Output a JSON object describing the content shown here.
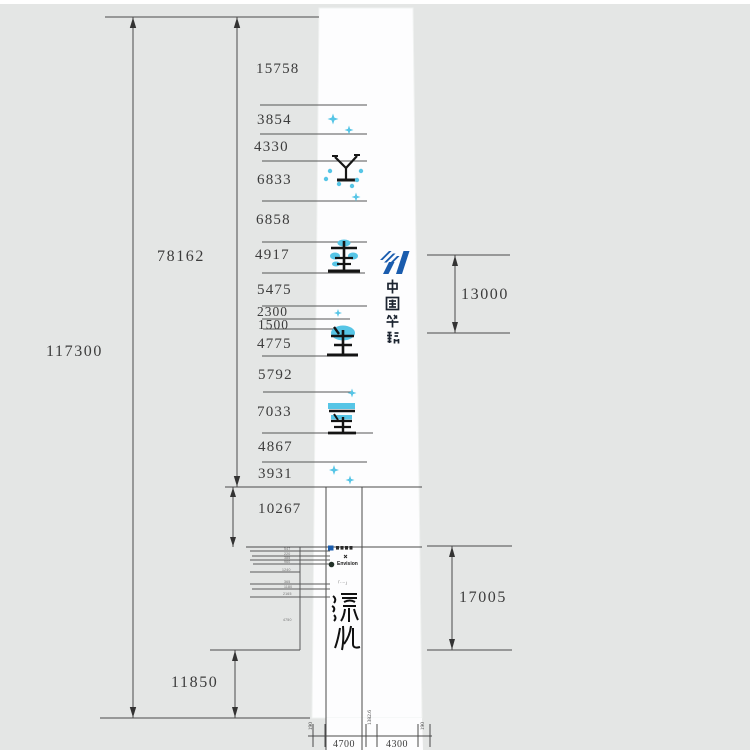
{
  "dimension_labels": {
    "total_height": "117300",
    "upper_section_height": "78162",
    "foundation_height": "11850",
    "logo_band_height": "13000",
    "artwork_band_height": "17005",
    "segments": [
      "15758",
      "3854",
      "4330",
      "6833",
      "6858",
      "4917",
      "5475",
      "2300",
      "1500",
      "4775",
      "5792",
      "7033",
      "4867",
      "3931",
      "10267"
    ],
    "base_widths": [
      "190",
      "4700",
      "1382.6",
      "4300",
      "190"
    ]
  },
  "branding": {
    "huaneng_wordmark": "中国华能",
    "partnership_mark": "×",
    "envision_label": "Envision"
  },
  "artwork": {
    "seal_script_characters": "演化",
    "plaque_caption": "「····」"
  },
  "detail_callout_labels": [
    "547",
    "220",
    "385",
    "960",
    "1240",
    "365",
    "1180",
    "2165",
    "4750"
  ],
  "colors": {
    "background": "#e4e6e5",
    "tower_fill": "#fdfdfe",
    "line": "#4a4a4a",
    "text": "#3c3c3c",
    "accent_cyan": "#56c5e6",
    "logo_blue": "#1a5cad"
  }
}
